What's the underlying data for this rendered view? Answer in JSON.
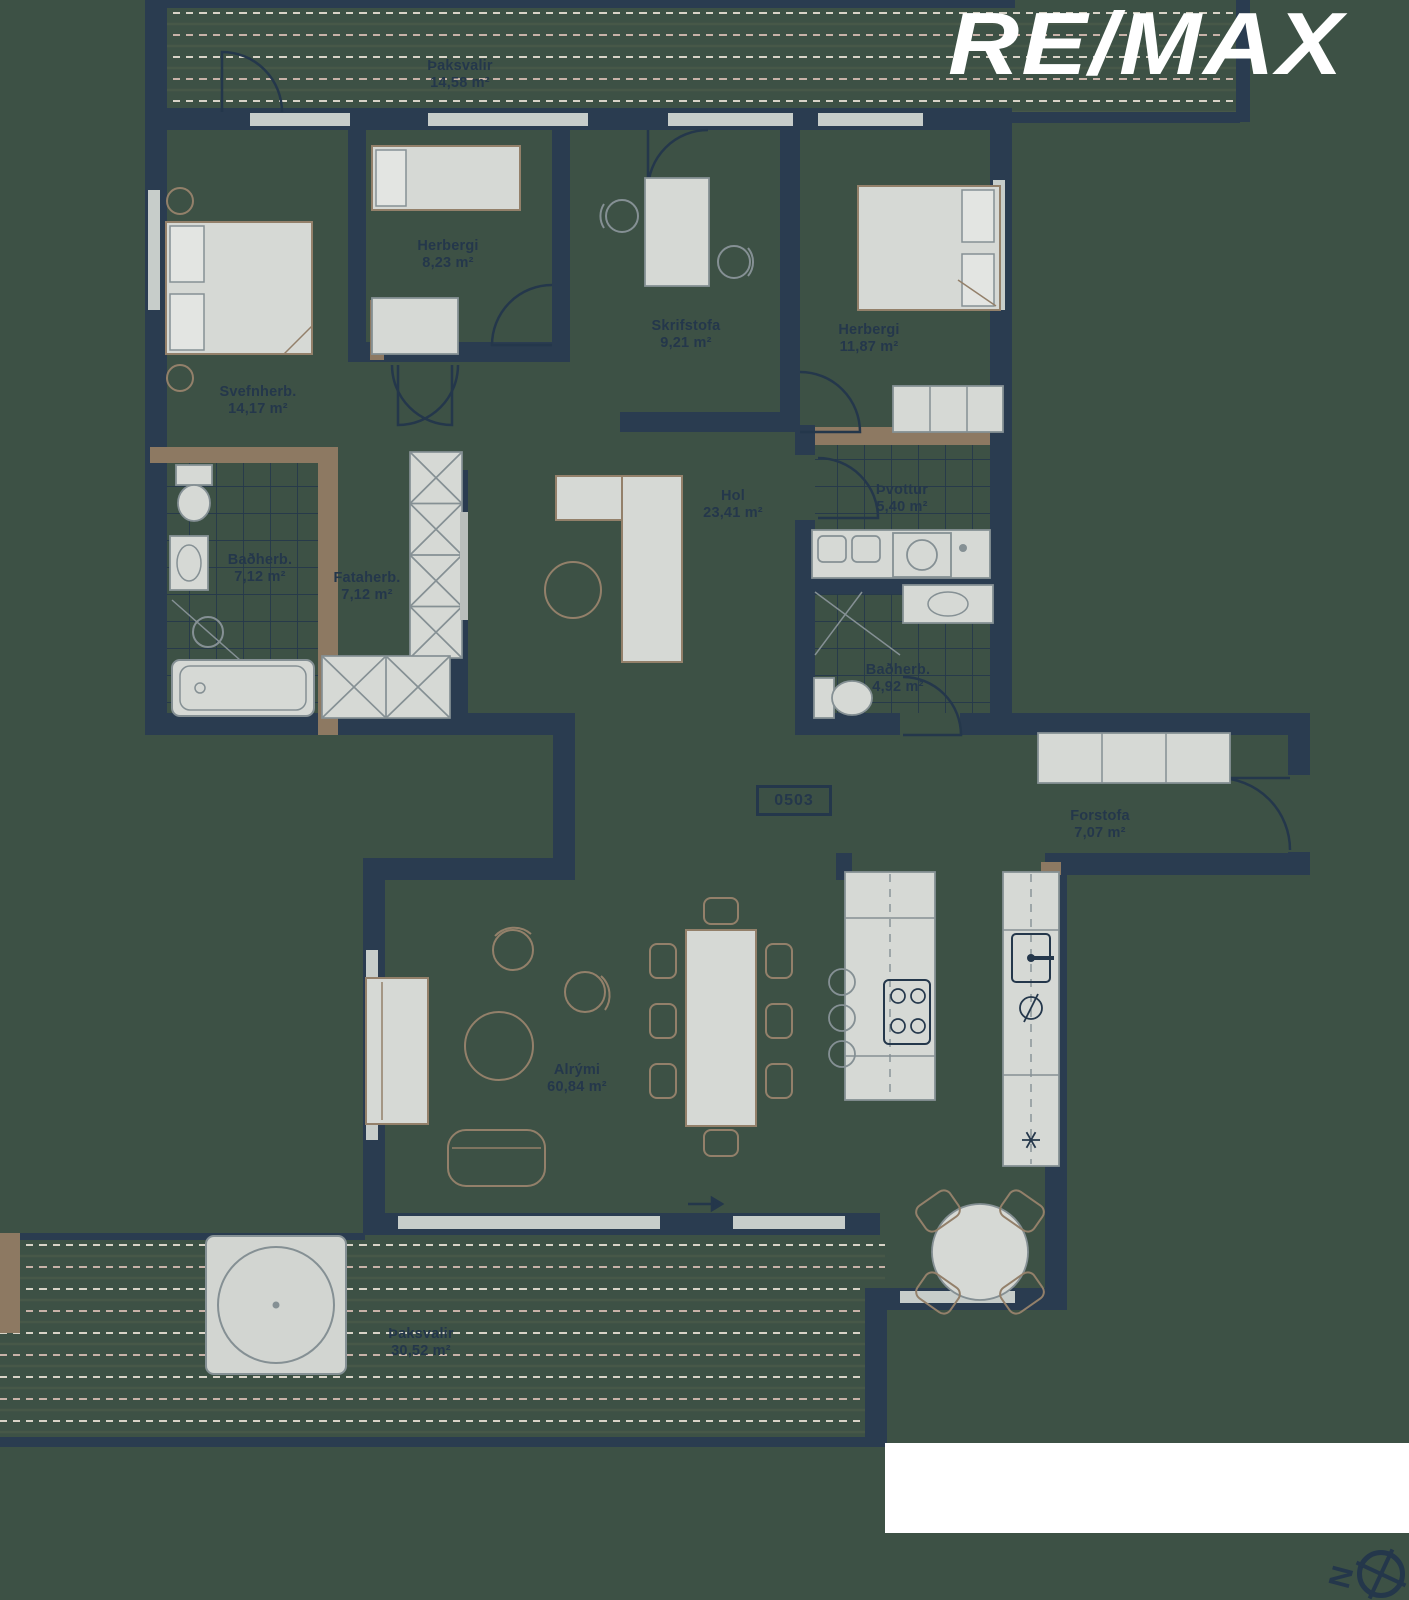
{
  "title": "Floor plan 0503",
  "logo": {
    "text": "RE/MAX"
  },
  "unit_tag": "0503",
  "compass": {
    "letter": "N"
  },
  "colors": {
    "background": "#3d5145",
    "wall": "#2a3c50",
    "wood": "#8d7962",
    "furniture_fill": "#d6d9d5",
    "furniture_stroke": "#859094",
    "furniture_wood_stroke": "#93806a",
    "window": "#c7cdca",
    "deck_line_solid": "#475848",
    "deck_line_cream": "#d8d3c7",
    "deck_line_rose": "#c8b2a8",
    "label_text": "#24374b",
    "logo_text": "#ffffff",
    "cutout": "#ffffff"
  },
  "rooms": [
    {
      "name": "Þaksvalir",
      "area": "14,58 m²"
    },
    {
      "name": "Herbergi",
      "area": "8,23 m²"
    },
    {
      "name": "Skrifstofa",
      "area": "9,21 m²"
    },
    {
      "name": "Herbergi",
      "area": "11,87 m²"
    },
    {
      "name": "Svefnherb.",
      "area": "14,17 m²"
    },
    {
      "name": "Baðherb.",
      "area": "7,12 m²"
    },
    {
      "name": "Fataherb.",
      "area": "7,12 m²"
    },
    {
      "name": "Hol",
      "area": "23,41 m²"
    },
    {
      "name": "Þvottur",
      "area": "5,40 m²"
    },
    {
      "name": "Baðherb.",
      "area": "4,92 m²"
    },
    {
      "name": "Forstofa",
      "area": "7,07 m²"
    },
    {
      "name": "Alrými",
      "area": "60,84 m²"
    },
    {
      "name": "Þaksvalir",
      "area": "30,52 m²"
    }
  ]
}
